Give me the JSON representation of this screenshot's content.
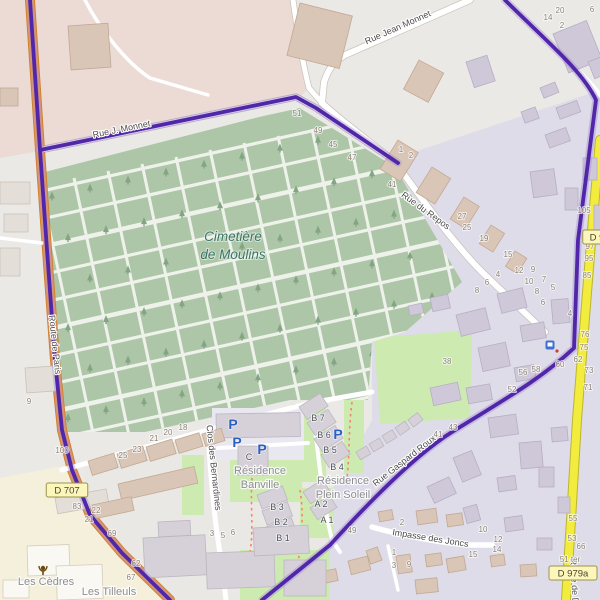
{
  "colors": {
    "base": "#ebe9e5",
    "pink_zone": "#ecdbd5",
    "lavender_zone": "#dedce8",
    "residence_zone": "#e9e8e4",
    "cream_zone": "#f4f0dc",
    "cemetery_green": "#adc6a8",
    "grass_green": "#cdeab0",
    "road_orange": "#ef9d4e",
    "road_yellow": "#f2ec3f",
    "route_purple": "#5126a8",
    "parking_blue": "#2a5fc4",
    "cemetery_label_teal": "#3c7568"
  },
  "cemetery_label": {
    "lines": [
      "Cimetière",
      "de Moulins"
    ],
    "x": 233,
    "y": 241,
    "line_height": 18
  },
  "street_labels": [
    {
      "name": "Rue J. Monnet",
      "x": 122,
      "y": 132,
      "angle": -11.5,
      "size": 9
    },
    {
      "name": "Rue Jean Monnet",
      "x": 399,
      "y": 30,
      "angle": -24,
      "size": 10
    },
    {
      "name": "Rue du Repos",
      "x": 424,
      "y": 213,
      "angle": 36,
      "size": 10
    },
    {
      "name": "Route de Paris",
      "x": 52,
      "y": 345,
      "angle": 84,
      "size": 9
    },
    {
      "name": "Rue Gaspard Roux",
      "x": 406,
      "y": 463,
      "angle": -38,
      "size": 9
    },
    {
      "name": "Clos des Bernardines",
      "x": 211,
      "y": 468,
      "angle": 84,
      "size": 9
    },
    {
      "name": "Impasse des Joncs",
      "x": 430,
      "y": 541,
      "angle": 9,
      "size": 11
    },
    {
      "name": "Route de Decize",
      "x": 572,
      "y": 592,
      "angle": 87,
      "size": 9
    }
  ],
  "area_labels": [
    {
      "lines": [
        "Résidence",
        "Banville"
      ],
      "x": 260,
      "y": 474,
      "line_height": 14
    },
    {
      "lines": [
        "Résidence",
        "Plein Soleil"
      ],
      "x": 343,
      "y": 484,
      "line_height": 14
    },
    {
      "lines": [
        "Les Cèdres"
      ],
      "x": 46,
      "y": 585,
      "line_height": 14
    },
    {
      "lines": [
        "Les Tilleuls"
      ],
      "x": 109,
      "y": 595,
      "line_height": 14
    }
  ],
  "road_refs": [
    {
      "ref": "D 707",
      "x": 67,
      "y": 490
    },
    {
      "ref": "D 979a",
      "x": 573,
      "y": 573
    },
    {
      "ref": "D 9",
      "x": 597,
      "y": 237
    }
  ],
  "building_labels": [
    {
      "n": "C",
      "x": 249,
      "y": 460
    },
    {
      "n": "B 7",
      "x": 318,
      "y": 421
    },
    {
      "n": "B 6",
      "x": 324,
      "y": 438
    },
    {
      "n": "B 5",
      "x": 330,
      "y": 453
    },
    {
      "n": "B 4",
      "x": 337,
      "y": 470
    },
    {
      "n": "B 3",
      "x": 277,
      "y": 510
    },
    {
      "n": "B 2",
      "x": 281,
      "y": 525
    },
    {
      "n": "B 1",
      "x": 283,
      "y": 541
    },
    {
      "n": "A 2",
      "x": 321,
      "y": 507
    },
    {
      "n": "A 1",
      "x": 327,
      "y": 523
    }
  ],
  "house_numbers": [
    {
      "n": "51",
      "x": 297,
      "y": 116
    },
    {
      "n": "49",
      "x": 318,
      "y": 133
    },
    {
      "n": "45",
      "x": 333,
      "y": 147
    },
    {
      "n": "47",
      "x": 352,
      "y": 160
    },
    {
      "n": "1",
      "x": 401,
      "y": 152
    },
    {
      "n": "2",
      "x": 411,
      "y": 158
    },
    {
      "n": "41",
      "x": 392,
      "y": 187
    },
    {
      "n": "27",
      "x": 462,
      "y": 219
    },
    {
      "n": "25",
      "x": 467,
      "y": 230
    },
    {
      "n": "19",
      "x": 484,
      "y": 241
    },
    {
      "n": "15",
      "x": 508,
      "y": 257
    },
    {
      "n": "12",
      "x": 519,
      "y": 273
    },
    {
      "n": "9",
      "x": 533,
      "y": 272
    },
    {
      "n": "10",
      "x": 529,
      "y": 284
    },
    {
      "n": "7",
      "x": 544,
      "y": 282
    },
    {
      "n": "8",
      "x": 537,
      "y": 294
    },
    {
      "n": "5",
      "x": 553,
      "y": 290
    },
    {
      "n": "6",
      "x": 543,
      "y": 305
    },
    {
      "n": "4",
      "x": 570,
      "y": 316
    },
    {
      "n": "4",
      "x": 498,
      "y": 277
    },
    {
      "n": "6",
      "x": 487,
      "y": 285
    },
    {
      "n": "8",
      "x": 477,
      "y": 293
    },
    {
      "n": "38",
      "x": 447,
      "y": 364
    },
    {
      "n": "105",
      "x": 584,
      "y": 213
    },
    {
      "n": "97",
      "x": 590,
      "y": 249
    },
    {
      "n": "95",
      "x": 589,
      "y": 261
    },
    {
      "n": "85",
      "x": 587,
      "y": 278
    },
    {
      "n": "76",
      "x": 585,
      "y": 337
    },
    {
      "n": "75",
      "x": 584,
      "y": 350
    },
    {
      "n": "62",
      "x": 578,
      "y": 362
    },
    {
      "n": "73",
      "x": 589,
      "y": 373
    },
    {
      "n": "71",
      "x": 588,
      "y": 390
    },
    {
      "n": "52",
      "x": 512,
      "y": 392
    },
    {
      "n": "56",
      "x": 523,
      "y": 375
    },
    {
      "n": "58",
      "x": 536,
      "y": 372
    },
    {
      "n": "60",
      "x": 560,
      "y": 367
    },
    {
      "n": "49",
      "x": 352,
      "y": 533
    },
    {
      "n": "43",
      "x": 453,
      "y": 430
    },
    {
      "n": "41",
      "x": 438,
      "y": 437
    },
    {
      "n": "25",
      "x": 123,
      "y": 458
    },
    {
      "n": "23",
      "x": 137,
      "y": 452
    },
    {
      "n": "21",
      "x": 154,
      "y": 441
    },
    {
      "n": "20",
      "x": 168,
      "y": 435
    },
    {
      "n": "18",
      "x": 183,
      "y": 430
    },
    {
      "n": "100",
      "x": 62,
      "y": 453
    },
    {
      "n": "83",
      "x": 77,
      "y": 509
    },
    {
      "n": "22",
      "x": 96,
      "y": 513
    },
    {
      "n": "21",
      "x": 89,
      "y": 522
    },
    {
      "n": "69",
      "x": 112,
      "y": 536
    },
    {
      "n": "62",
      "x": 136,
      "y": 566
    },
    {
      "n": "67",
      "x": 131,
      "y": 580
    },
    {
      "n": "3",
      "x": 212,
      "y": 536
    },
    {
      "n": "5",
      "x": 223,
      "y": 538
    },
    {
      "n": "6",
      "x": 233,
      "y": 535
    },
    {
      "n": "2",
      "x": 402,
      "y": 525
    },
    {
      "n": "10",
      "x": 483,
      "y": 532
    },
    {
      "n": "12",
      "x": 498,
      "y": 542
    },
    {
      "n": "14",
      "x": 497,
      "y": 552
    },
    {
      "n": "15",
      "x": 473,
      "y": 557
    },
    {
      "n": "1",
      "x": 394,
      "y": 555
    },
    {
      "n": "3",
      "x": 394,
      "y": 568
    },
    {
      "n": "9",
      "x": 409,
      "y": 567
    },
    {
      "n": "55",
      "x": 573,
      "y": 521
    },
    {
      "n": "53",
      "x": 572,
      "y": 541
    },
    {
      "n": "66",
      "x": 581,
      "y": 549
    },
    {
      "n": "51 ter",
      "x": 570,
      "y": 562
    },
    {
      "n": "20",
      "x": 560,
      "y": 13
    },
    {
      "n": "14",
      "x": 548,
      "y": 20
    },
    {
      "n": "6",
      "x": 592,
      "y": 12
    },
    {
      "n": "2",
      "x": 562,
      "y": 28
    },
    {
      "n": "9",
      "x": 29,
      "y": 404
    }
  ],
  "parking_icons": [
    {
      "x": 233,
      "y": 429
    },
    {
      "x": 237,
      "y": 447
    },
    {
      "x": 262,
      "y": 454
    },
    {
      "x": 338,
      "y": 439
    }
  ],
  "poi_icons": [
    {
      "name": "bus-stop-icon",
      "x": 550,
      "y": 345
    },
    {
      "name": "monument-icon",
      "x": 43,
      "y": 570
    }
  ]
}
